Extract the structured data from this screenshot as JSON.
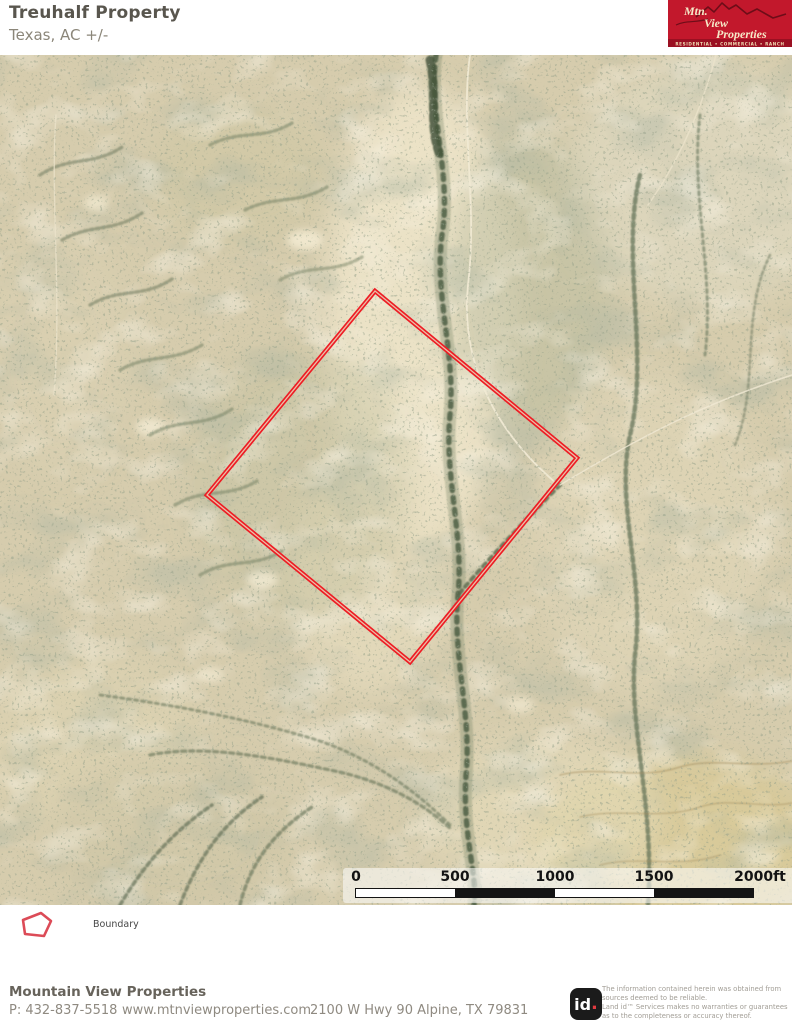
{
  "header": {
    "title": "Treuhalf Property",
    "subtitle": "Texas,  AC +/-"
  },
  "brand_logo": {
    "word1": "Mtn.",
    "word2": "View",
    "word3": "Properties",
    "tagline": "RESIDENTIAL • COMMERCIAL • RANCH",
    "bg_color": "#c2182c",
    "band_color": "#9a1022",
    "text_color": "#f5e9c8"
  },
  "map": {
    "type": "aerial-imagery",
    "boundary_color": "#ee1c24",
    "legend_label": "Boundary",
    "scalebar": {
      "ticks": [
        "0",
        "500",
        "1000",
        "1500",
        "2000ft"
      ]
    }
  },
  "footer": {
    "company": "Mountain View Properties",
    "phone": "P: 432-837-5518",
    "website": "www.mtnviewproperties.com",
    "address": "2100 W Hwy 90 Alpine, TX 79831",
    "land_id": {
      "text": "id",
      "dot": "."
    },
    "disclaimer_lines": [
      "The information contained herein was obtained from",
      "sources deemed to be reliable.",
      " Land id™ Services makes no warranties or guarantees",
      "as to the completeness or accuracy thereof."
    ]
  }
}
